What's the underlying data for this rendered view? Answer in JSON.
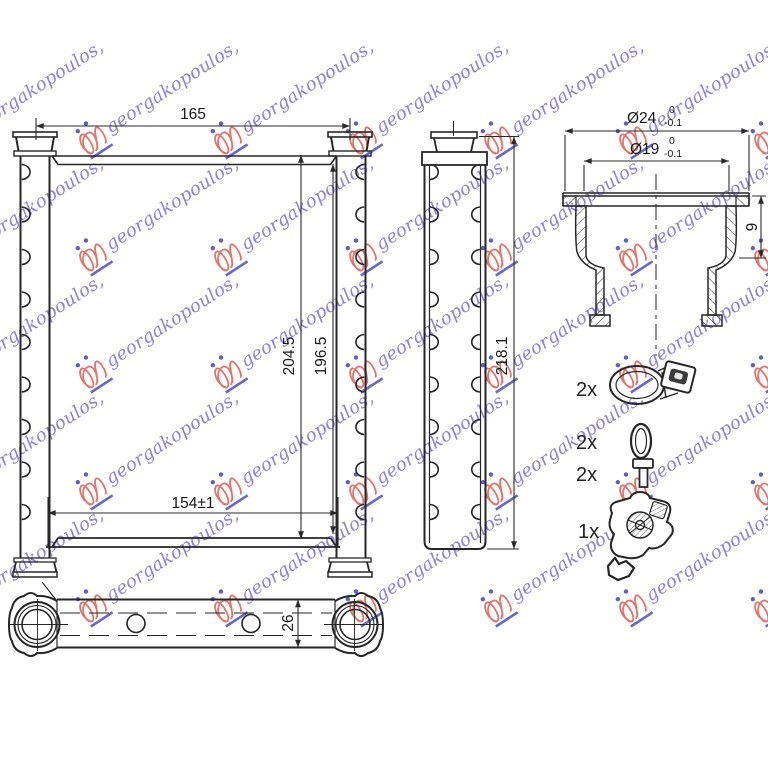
{
  "watermark": {
    "text": "georgakopoulos,",
    "text_color": "#7b6bd6",
    "logo_color": "#d95f55",
    "accent_color": "#4343bd"
  },
  "line_color": "#262626",
  "views": {
    "front": {
      "width_dim": "165",
      "height_outer": "204.5",
      "height_inner": "196.5",
      "core_width": "154±1"
    },
    "side": {
      "height": "218.1"
    },
    "bottom": {
      "depth": "26"
    },
    "fitting": {
      "outer_dia": "Ø24",
      "outer_tol_top": "0",
      "outer_tol_bottom": "-0.1",
      "inner_dia": "Ø19",
      "inner_tol_top": "0",
      "inner_tol_bottom": "-0.1",
      "collar_depth": "9"
    }
  },
  "parts": [
    {
      "qty": "2x",
      "name": "hose-clamp"
    },
    {
      "qty": "2x",
      "name": "o-ring"
    },
    {
      "qty": "2x",
      "name": "screw"
    },
    {
      "qty": "1x",
      "name": "mounting-bracket"
    }
  ]
}
